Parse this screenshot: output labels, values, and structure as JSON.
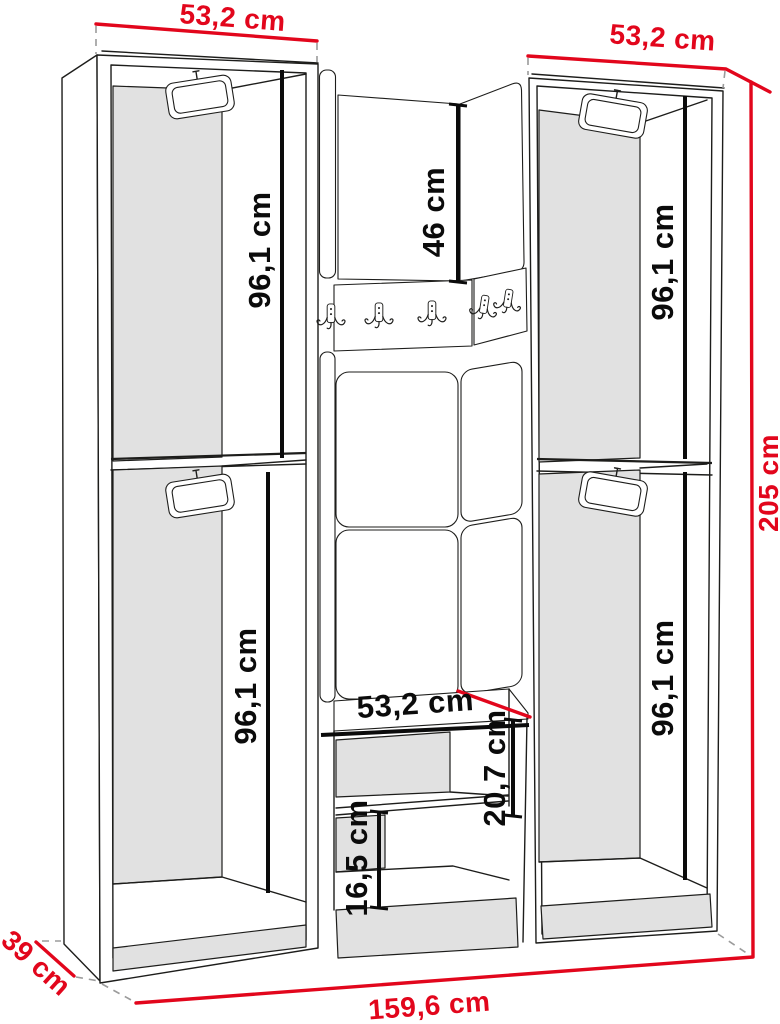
{
  "diagram": {
    "type": "furniture-dimension-drawing",
    "subject": "hallway wardrobe set with bench and coat hooks, perspective line drawing",
    "unit": "cm",
    "colors": {
      "dimension_red": "#e2061c",
      "outline": "#1d1d1b",
      "panel_fill": "#e1e1e1",
      "extension_dash": "#9b9b9b",
      "background": "#ffffff"
    }
  },
  "labels": {
    "left_cabinet_width": "53,2 cm",
    "right_cabinet_width": "53,2 cm",
    "total_height": "205 cm",
    "total_width": "159,6 cm",
    "depth": "39 cm",
    "left_upper_compartment_height": "96,1 cm",
    "left_lower_compartment_height": "96,1 cm",
    "right_upper_compartment_height": "96,1 cm",
    "right_lower_compartment_height": "96,1 cm",
    "middle_top_panel_height": "46 cm",
    "bench_width": "53,2 cm",
    "bench_upper_shelf_gap": "20,7 cm",
    "bench_lower_shelf_gap": "16,5 cm"
  }
}
